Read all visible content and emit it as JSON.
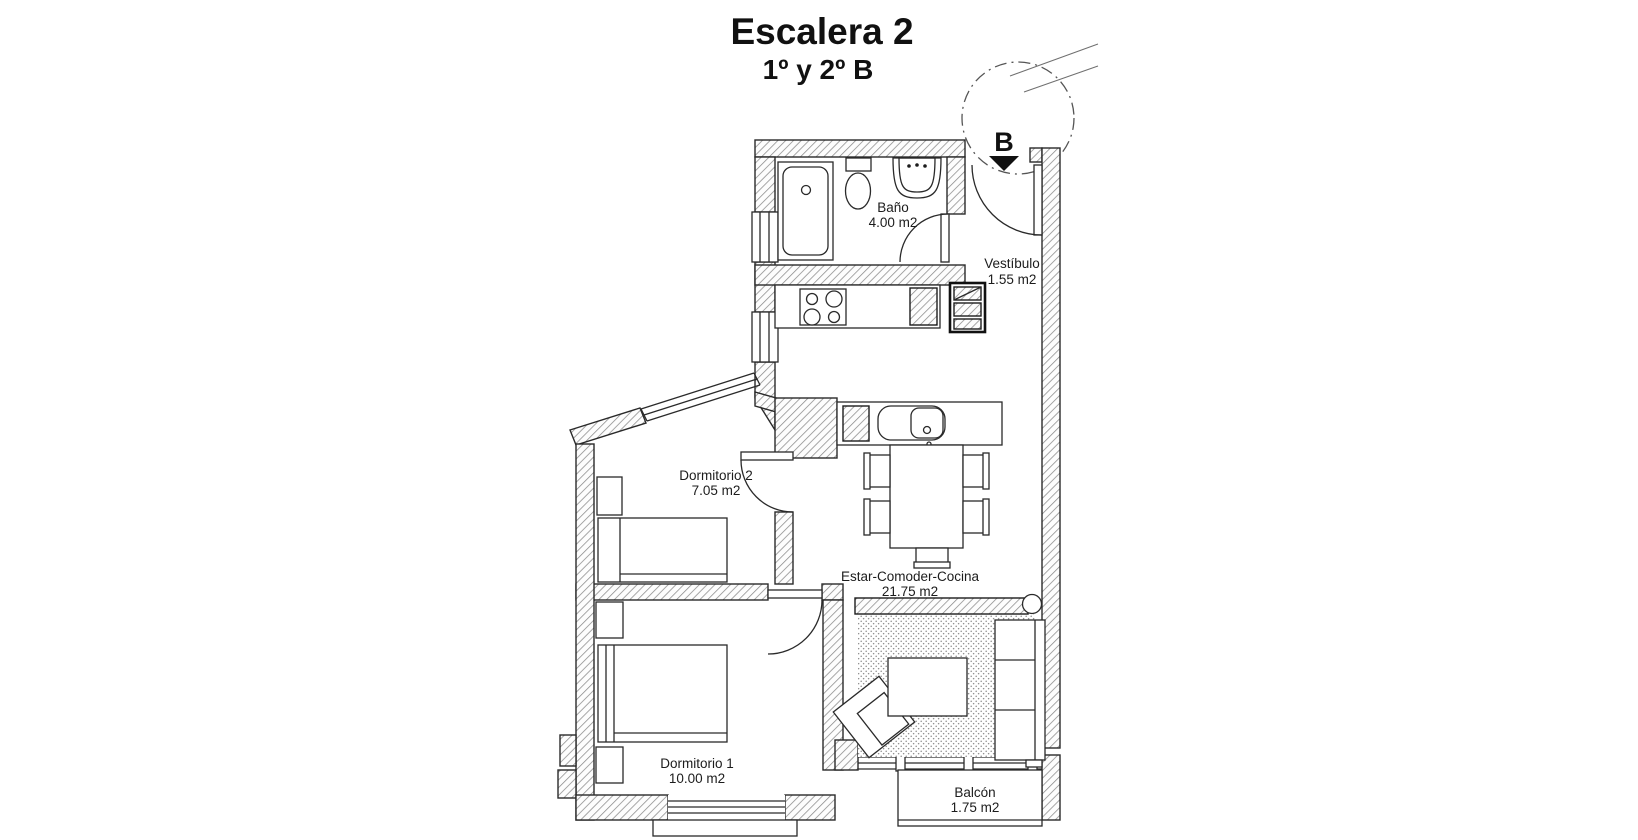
{
  "title": {
    "line1": "Escalera 2",
    "line2": "1º y 2º B"
  },
  "stair": {
    "label": "B"
  },
  "rooms": {
    "bano": {
      "name": "Baño",
      "area": "4.00 m2"
    },
    "vestibulo": {
      "name": "Vestíbulo",
      "area": "1.55 m2"
    },
    "dormitorio2": {
      "name": "Dormitorio 2",
      "area": "7.05 m2"
    },
    "estar": {
      "name": "Estar-Comoder-Cocina",
      "area": "21.75 m2"
    },
    "dormitorio1": {
      "name": "Dormitorio 1",
      "area": "10.00 m2"
    },
    "balcon": {
      "name": "Balcón",
      "area": "1.75 m2"
    }
  },
  "colors": {
    "background": "#ffffff",
    "line": "#1c1c1c",
    "wall_hatch": "#8a8a8a",
    "text": "#1c1c1c"
  }
}
